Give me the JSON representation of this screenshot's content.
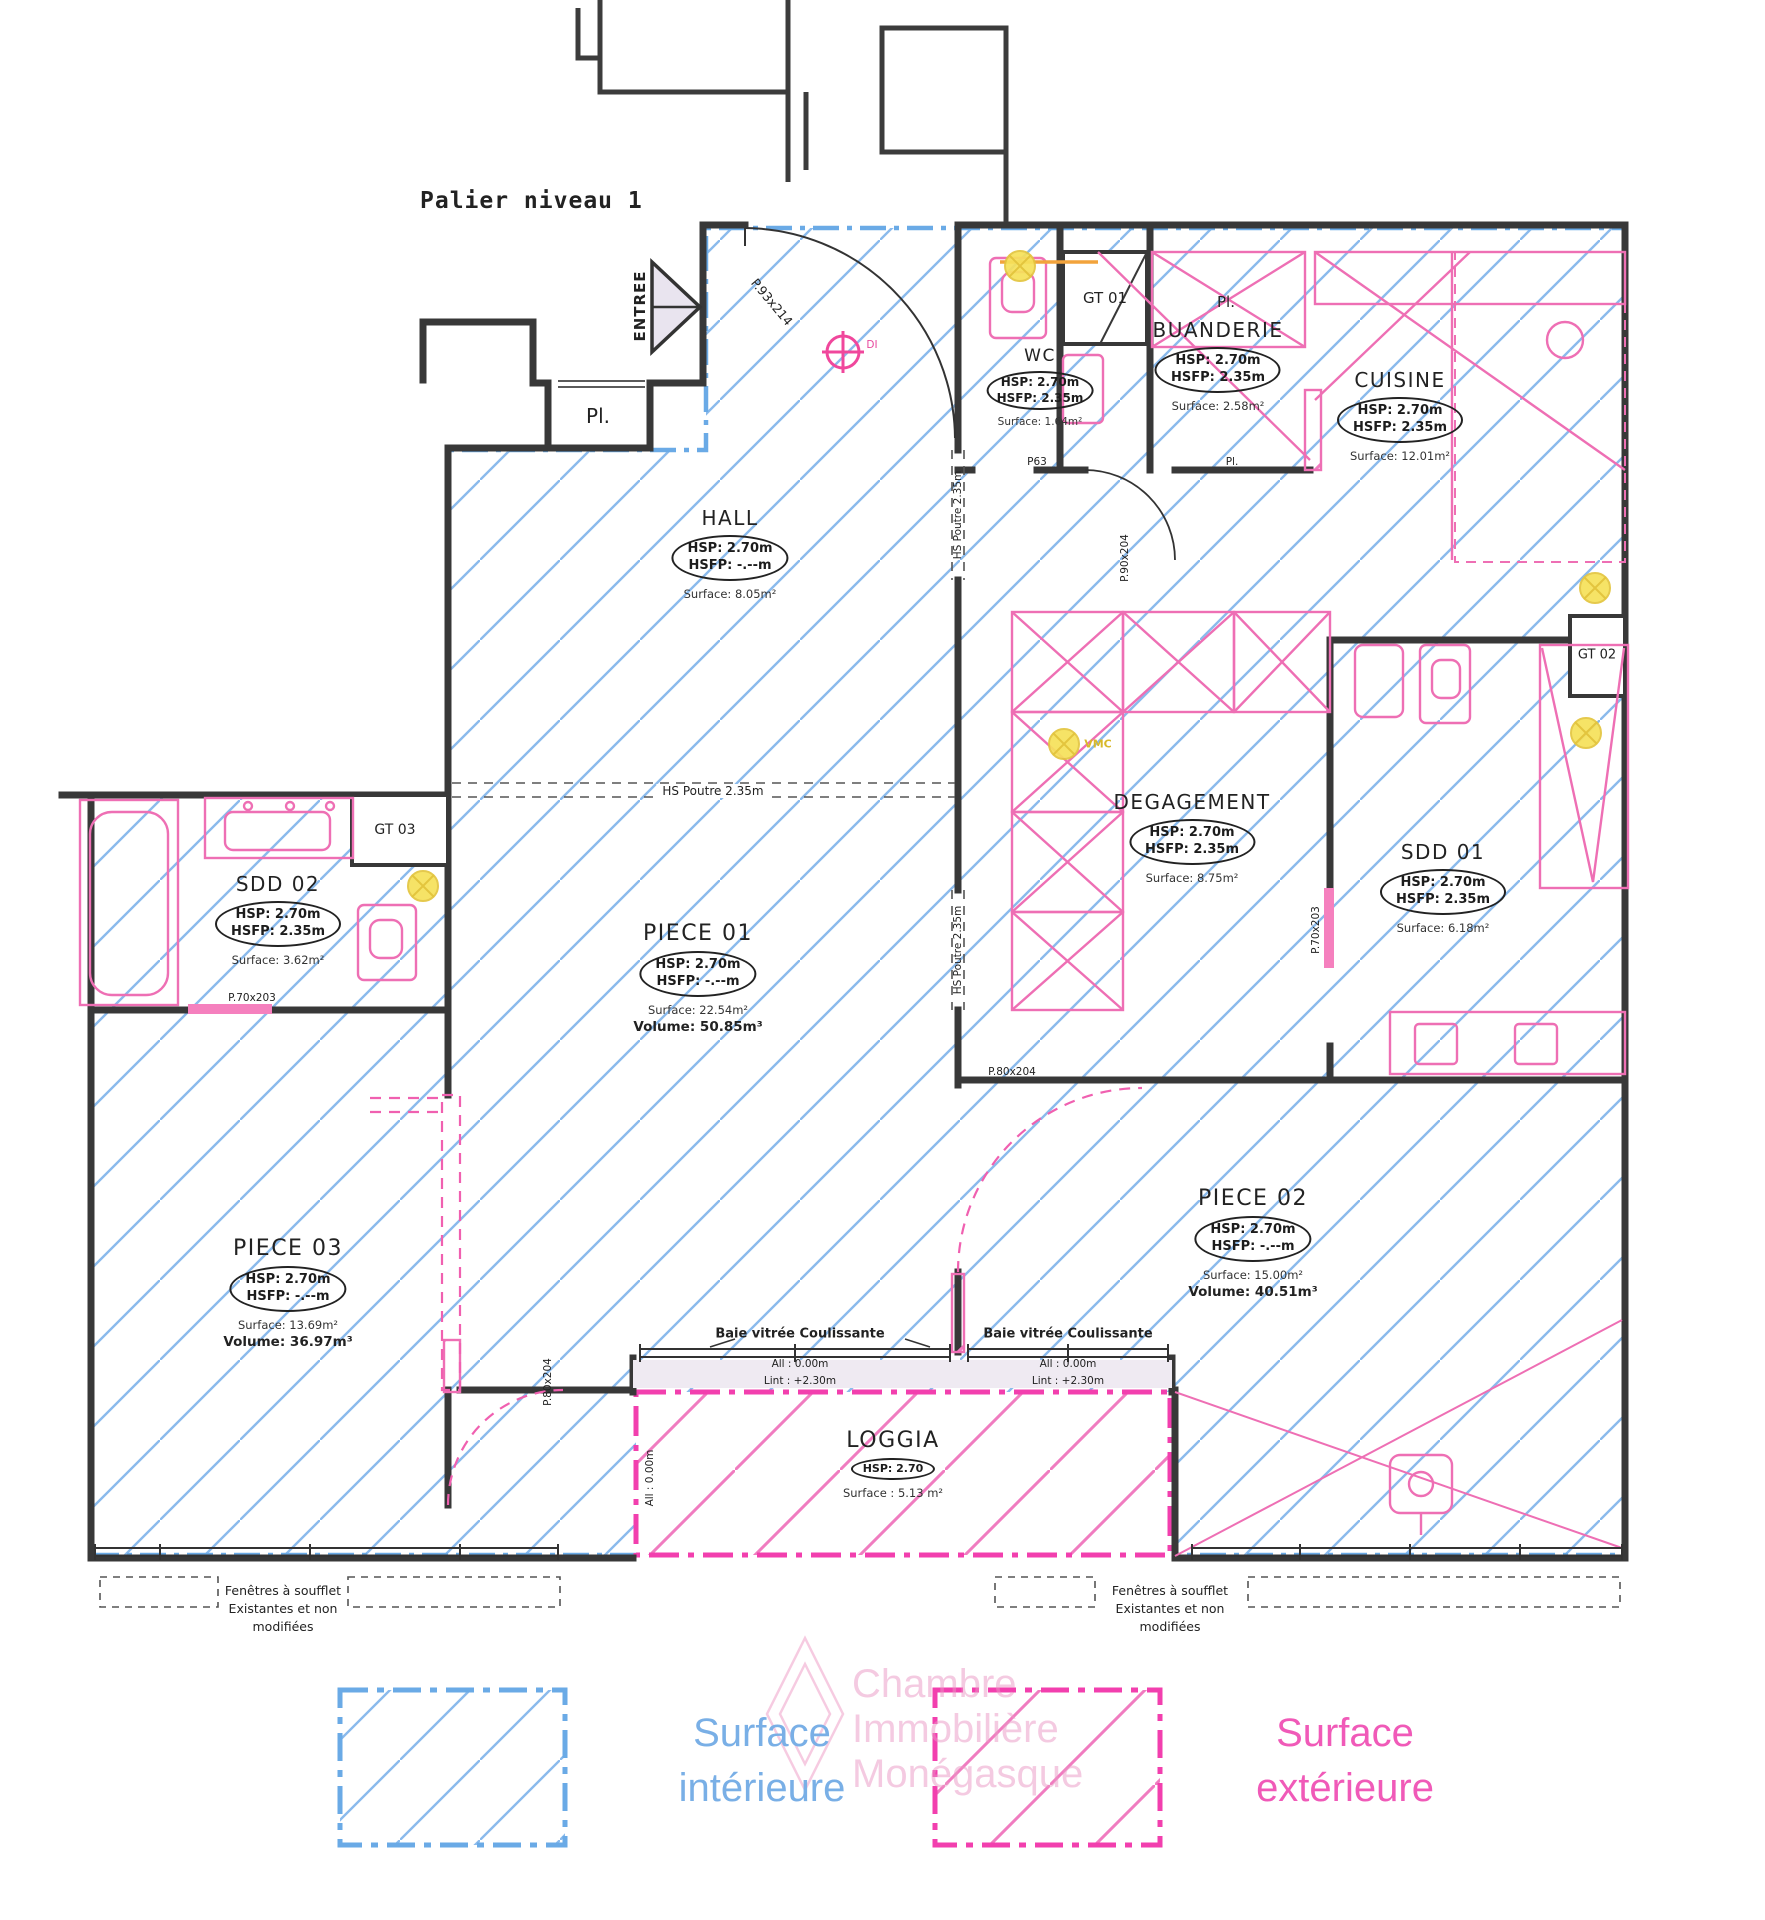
{
  "title": "Palier niveau 1",
  "labels": {
    "entree": "ENTREE",
    "pl_landing": "Pl.",
    "pl_buanderie": "Pl.",
    "pl_corridor": "Pl.",
    "gt01": "GT 01",
    "gt02": "GT 02",
    "gt03": "GT 03",
    "vmc": "VMC",
    "di": "DI"
  },
  "rooms": [
    {
      "name": "HALL",
      "hsp": "HSP: 2.70m",
      "hsfp": "HSFP: -.--m",
      "surface": "Surface: 8.05m²"
    },
    {
      "name": "WC",
      "hsp": "HSP: 2.70m",
      "hsfp": "HSFP: 2.35m",
      "surface": "Surface: 1.64m²"
    },
    {
      "name": "BUANDERIE",
      "hsp": "HSP: 2.70m",
      "hsfp": "HSFP: 2.35m",
      "surface": "Surface: 2.58m²"
    },
    {
      "name": "CUISINE",
      "hsp": "HSP: 2.70m",
      "hsfp": "HSFP: 2.35m",
      "surface": "Surface: 12.01m²"
    },
    {
      "name": "DEGAGEMENT",
      "hsp": "HSP: 2.70m",
      "hsfp": "HSFP: 2.35m",
      "surface": "Surface: 8.75m²"
    },
    {
      "name": "SDD 01",
      "hsp": "HSP: 2.70m",
      "hsfp": "HSFP: 2.35m",
      "surface": "Surface: 6.18m²"
    },
    {
      "name": "SDD 02",
      "hsp": "HSP: 2.70m",
      "hsfp": "HSFP: 2.35m",
      "surface": "Surface: 3.62m²"
    },
    {
      "name": "PIECE 01",
      "hsp": "HSP: 2.70m",
      "hsfp": "HSFP: -.--m",
      "surface": "Surface: 22.54m²",
      "volume": "Volume: 50.85m³"
    },
    {
      "name": "PIECE 02",
      "hsp": "HSP: 2.70m",
      "hsfp": "HSFP: -.--m",
      "surface": "Surface: 15.00m²",
      "volume": "Volume: 40.51m³"
    },
    {
      "name": "PIECE 03",
      "hsp": "HSP: 2.70m",
      "hsfp": "HSFP: -.--m",
      "surface": "Surface: 13.69m²",
      "volume": "Volume: 36.97m³"
    },
    {
      "name": "LOGGIA",
      "hsp": "HSP: 2.70",
      "surface": "Surface : 5.13 m²"
    }
  ],
  "doors": {
    "entrance": "P.93x214",
    "wc": "P63",
    "corridor": "P.90x204",
    "sdd02": "P.70x203",
    "sdd01": "P.70x203",
    "piece02": "P.80x204",
    "piece03": "P.80x204"
  },
  "beams": {
    "hall": "HS Poutre 2.35m",
    "upper": "HS Poutre 2.35m",
    "lower": "HS Poutre 2.35m"
  },
  "windows": {
    "baie": "Baie vitrée Coulissante",
    "allege": "All : 0.00m",
    "linteau": "Lint : +2.30m",
    "note1": "Fenêtres à soufflet",
    "note2": "Existantes et non",
    "note3": "modifiées"
  },
  "legend": {
    "interior1": "Surface",
    "interior2": "intérieure",
    "exterior1": "Surface",
    "exterior2": "extérieure"
  },
  "watermark": {
    "l1": "Chambre",
    "l2": "Immobilière",
    "l3": "Monégasque"
  },
  "colors": {
    "interior_boundary": "#6aaae6",
    "exterior_boundary": "#f23fae",
    "hatch_blue": "#8abaec",
    "hatch_pink": "#f07cc0",
    "wall": "#383838",
    "fixture_pink": "#ee6fb4",
    "vmc_yellow": "#f6e15a"
  }
}
